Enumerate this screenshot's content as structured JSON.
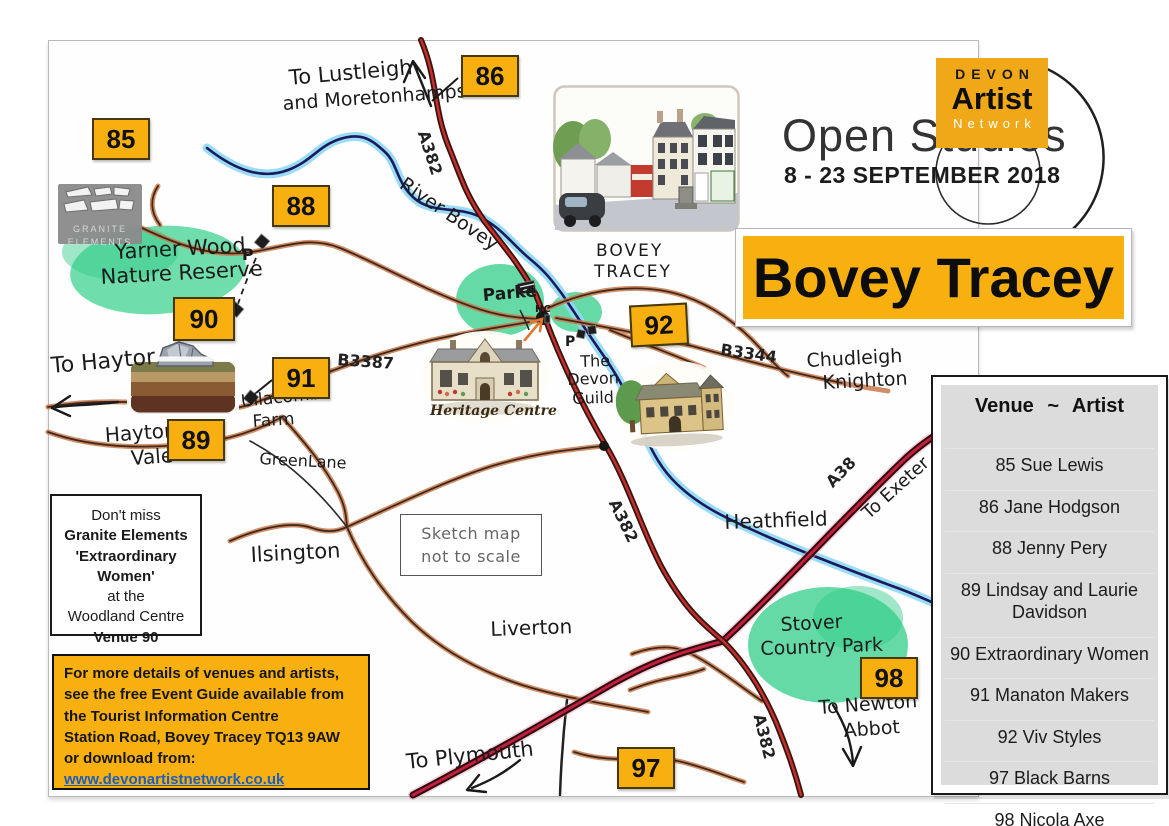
{
  "logo": {
    "devon": "DEVON",
    "artist": "Artist",
    "network": "Network",
    "open_studios": "Open Studios",
    "dates": "8 - 23 SEPTEMBER 2018"
  },
  "banner": {
    "title": "Bovey Tracey"
  },
  "venue_list": {
    "header": "Venue ~ Artist",
    "items": [
      {
        "num": "85",
        "artist": "Sue Lewis"
      },
      {
        "num": "86",
        "artist": "Jane Hodgson"
      },
      {
        "num": "88",
        "artist": "Jenny Pery"
      },
      {
        "num": "89",
        "artist": "Lindsay and Laurie Davidson"
      },
      {
        "num": "90",
        "artist": "Extraordinary Women"
      },
      {
        "num": "91",
        "artist": "Manaton Makers"
      },
      {
        "num": "92",
        "artist": "Viv Styles"
      },
      {
        "num": "97",
        "artist": "Black Barns"
      },
      {
        "num": "98",
        "artist": "Nicola Axe"
      }
    ]
  },
  "markers": {
    "m85": "85",
    "m86": "86",
    "m88": "88",
    "m89": "89",
    "m90": "90",
    "m91": "91",
    "m92": "92",
    "m97": "97",
    "m98": "98"
  },
  "map_labels": {
    "to_lustleigh": "To Lustleigh",
    "and_moretonhampstead": "and Moretonhampstead",
    "a382_top": "A382",
    "river_bovey": "River Bovey",
    "yarner_wood": "Yarner Wood",
    "nature_reserve": "Nature Reserve",
    "parking_1": "P",
    "to_haytor": "To Haytor",
    "haytor": "Haytor",
    "vale": "Vale",
    "ullacombe": "Ullacombe",
    "farm": "Farm",
    "green_lane": "GreenLane",
    "b3387": "B3387",
    "ilsington": "Ilsington",
    "liverton": "Liverton",
    "parke": "Parke",
    "hc": "HC",
    "bovey": "BOVEY",
    "tracey": "TRACEY",
    "parking_2": "P",
    "the": "The",
    "devon": "Devon",
    "guild": "Guild",
    "b3344": "B3344",
    "chudleigh": "Chudleigh",
    "knighton": "Knighton",
    "a38": "A38",
    "to_exeter": "To Exeter",
    "heathfield": "Heathfield",
    "a382_mid": "A382",
    "stover": "Stover",
    "country_park": "Country Park",
    "a382_bottom": "A382",
    "to_newton": "To Newton",
    "abbot": "Abbot",
    "to_plymouth": "To Plymouth",
    "note_line1": "Sketch map",
    "note_line2": "not to scale",
    "heritage_caption": "Heritage Centre"
  },
  "granite_logo": {
    "line1": "GRANITE",
    "line2": "ELEMENTS"
  },
  "dont_miss": {
    "line1": "Don't miss",
    "line2": "Granite Elements",
    "line3": "'Extraordinary Women'",
    "line4": "at the",
    "line5": "Woodland Centre",
    "line6": "Venue 90"
  },
  "info_box": {
    "line1": "For more details of venues and artists,",
    "line2": "see the free Event Guide available from",
    "line3": "the Tourist Information Centre",
    "line4": "Station Road,  Bovey Tracey  TQ13 9AW",
    "line5": "or download from:",
    "link": "www.devonartistnetwork.co.uk"
  },
  "colors": {
    "gold": "#F8B011",
    "list_gray": "#DCDCDC",
    "link_blue": "#1D5EBD",
    "river_blue": "#8FD8F2",
    "park_green": "#3FD190",
    "road_red": "#C5302C",
    "road_brown": "#C97B4E"
  }
}
